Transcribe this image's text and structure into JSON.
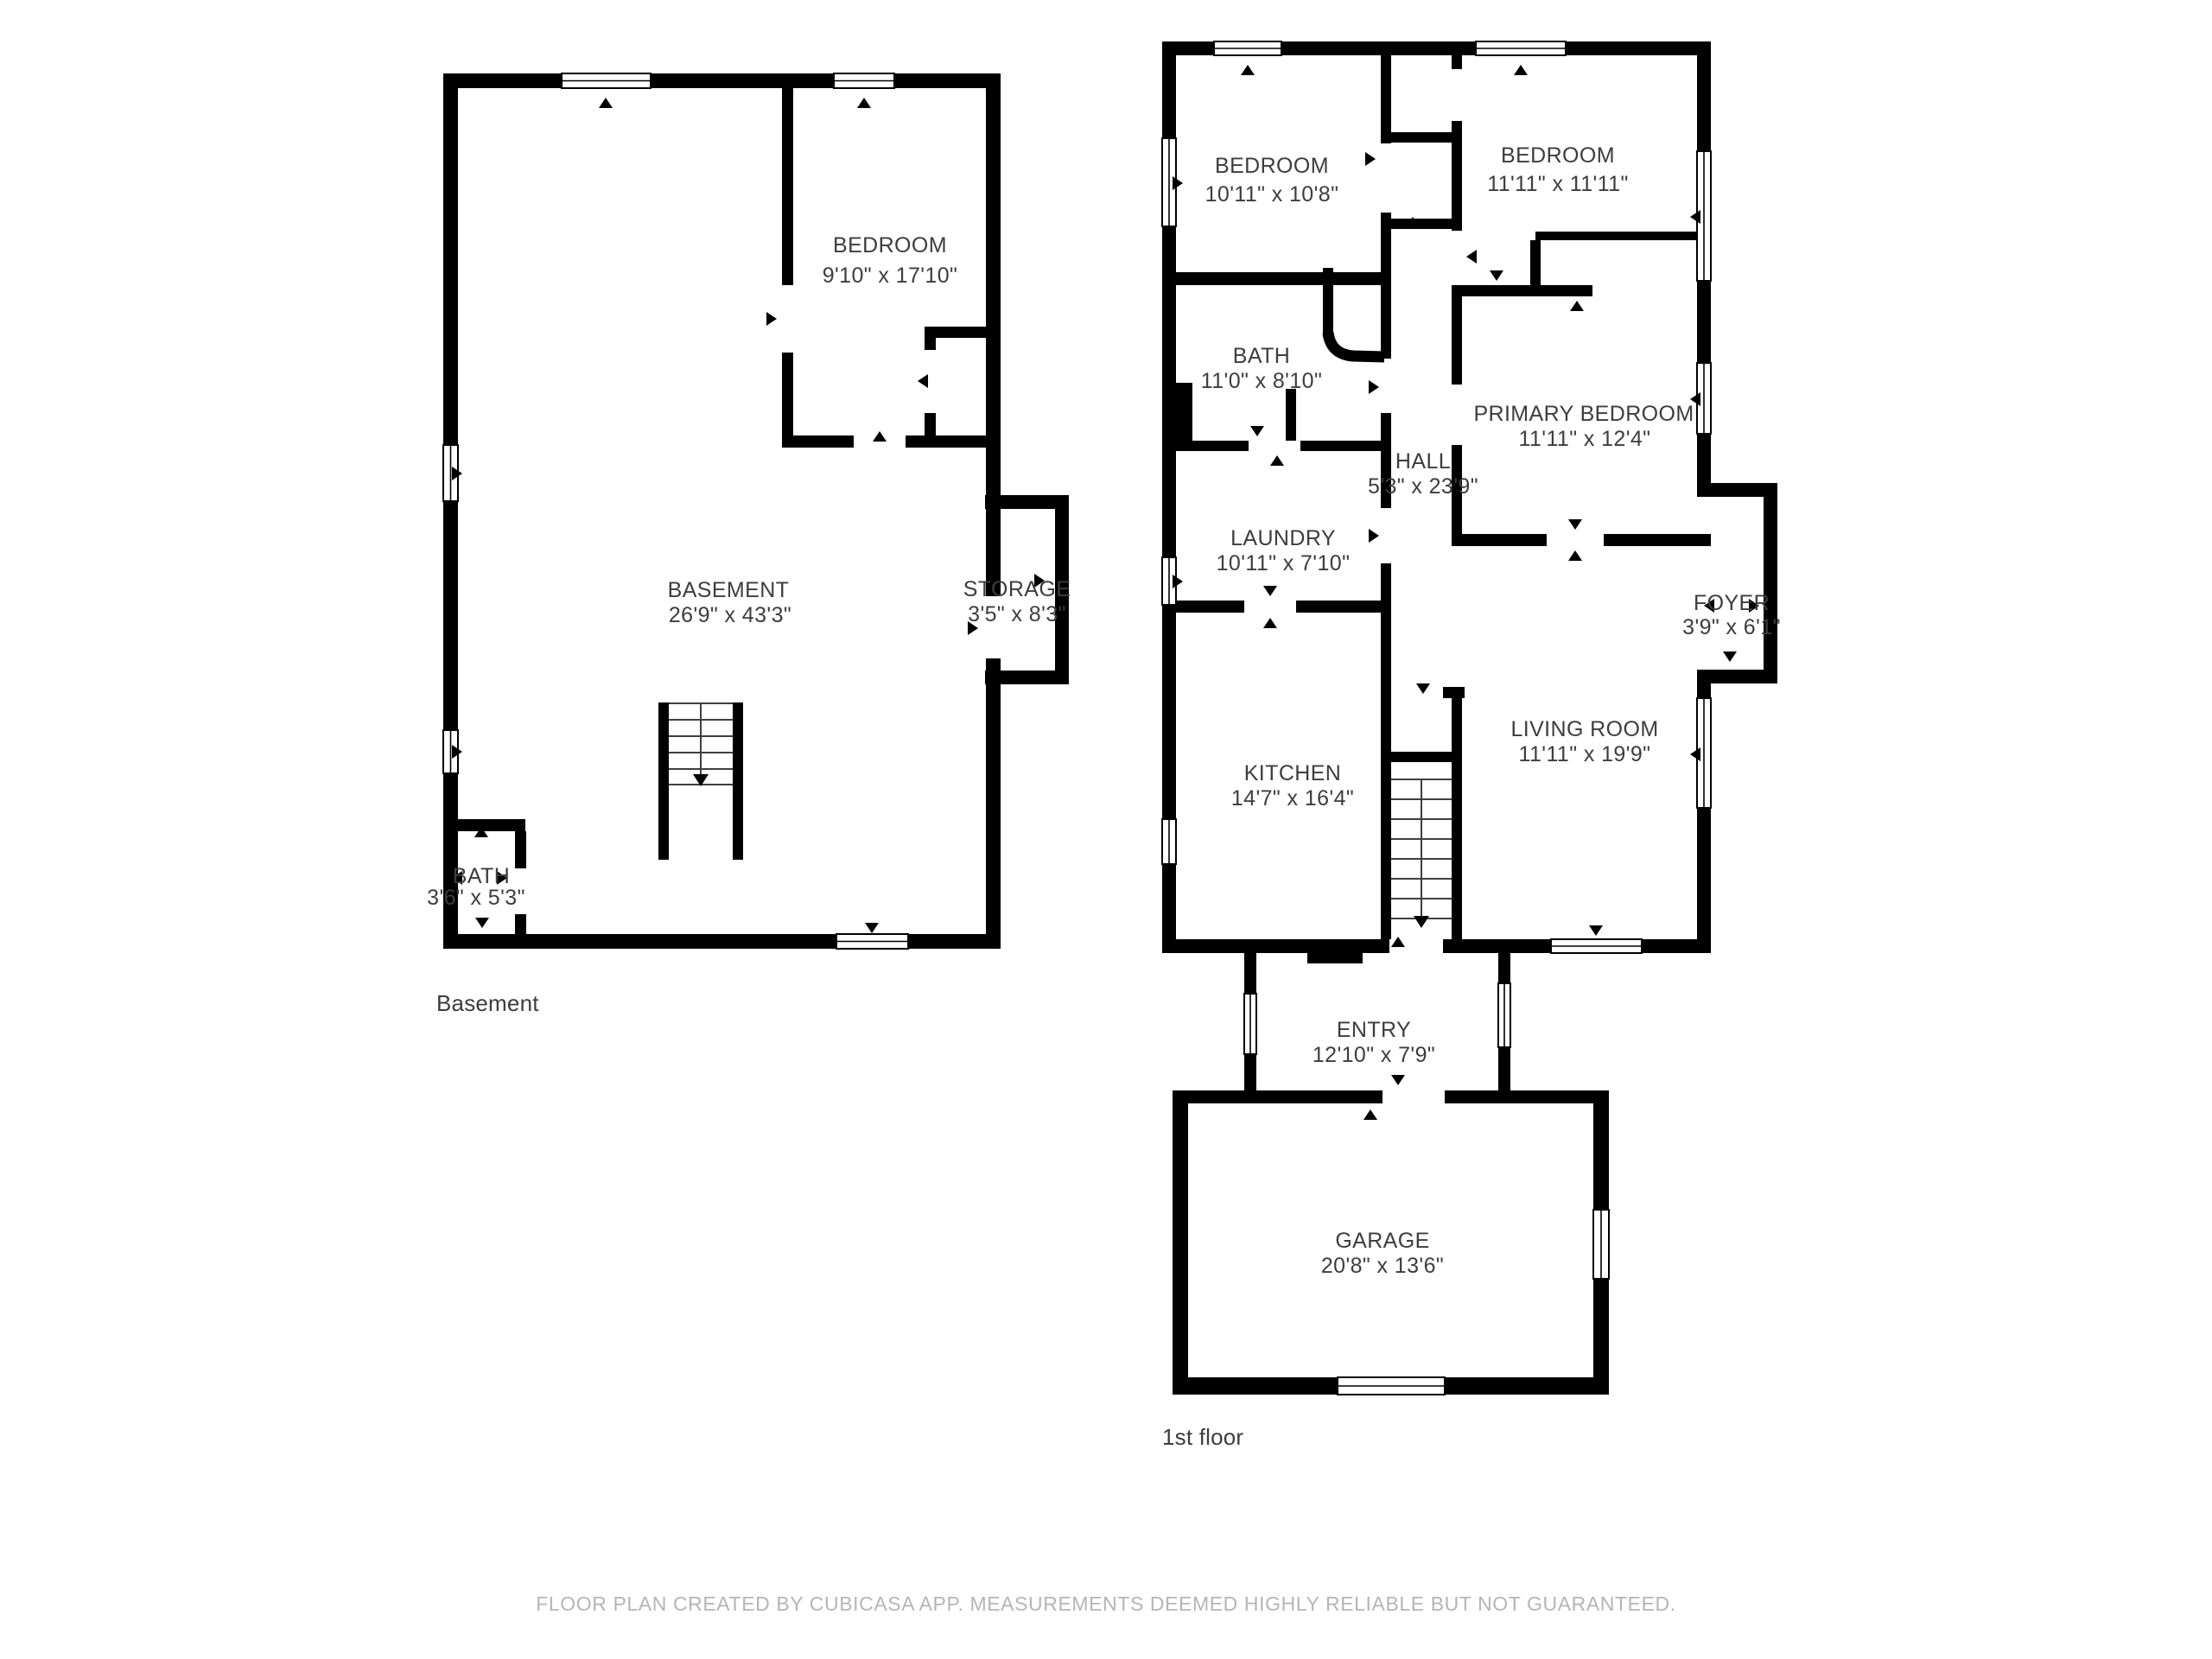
{
  "colors": {
    "wall": "#000000",
    "label": "#3d3d3d",
    "footer_text": "#b5b5b5",
    "background": "#ffffff"
  },
  "floors": [
    {
      "id": "basement",
      "caption": "Basement",
      "rooms": [
        {
          "name": "BEDROOM",
          "dims": "9'10\" x 17'10\""
        },
        {
          "name": "BASEMENT",
          "dims": "26'9\" x 43'3\""
        },
        {
          "name": "STORAGE",
          "dims": "3'5\" x 8'3\""
        },
        {
          "name": "BATH",
          "dims": "3'6\" x 5'3\""
        }
      ]
    },
    {
      "id": "first-floor",
      "caption": "1st floor",
      "rooms": [
        {
          "name": "BEDROOM",
          "dims": "10'11\" x 10'8\""
        },
        {
          "name": "BEDROOM",
          "dims": "11'11\" x 11'11\""
        },
        {
          "name": "BATH",
          "dims": "11'0\" x 8'10\""
        },
        {
          "name": "PRIMARY BEDROOM",
          "dims": "11'11\" x 12'4\""
        },
        {
          "name": "HALL",
          "dims": "5'3\" x 23'9\""
        },
        {
          "name": "LAUNDRY",
          "dims": "10'11\" x 7'10\""
        },
        {
          "name": "FOYER",
          "dims": "3'9\" x 6'1\""
        },
        {
          "name": "LIVING ROOM",
          "dims": "11'11\" x 19'9\""
        },
        {
          "name": "KITCHEN",
          "dims": "14'7\" x 16'4\""
        },
        {
          "name": "ENTRY",
          "dims": "12'10\" x 7'9\""
        },
        {
          "name": "GARAGE",
          "dims": "20'8\" x 13'6\""
        }
      ]
    }
  ],
  "footer": {
    "text": "FLOOR PLAN CREATED BY CUBICASA APP. MEASUREMENTS DEEMED HIGHLY RELIABLE BUT NOT GUARANTEED."
  }
}
